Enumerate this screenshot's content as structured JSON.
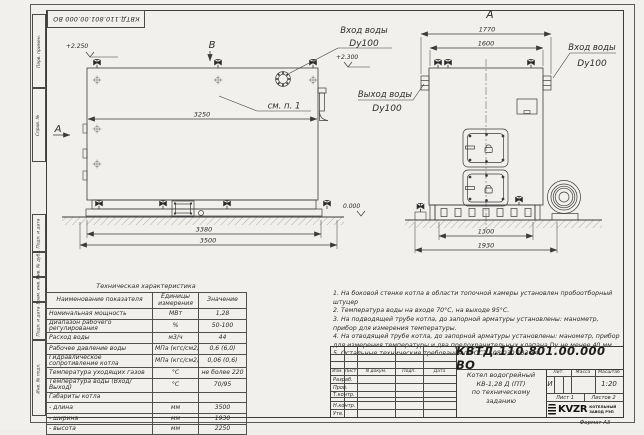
{
  "colors": {
    "paper": "#f1f0ec",
    "line": "#3b3b3b",
    "text": "#2c2c2c"
  },
  "stamp_top": "КВТД.110.801.00.000 ВО",
  "frame": {
    "format_note": "Формат А3",
    "columns": [
      "Перв. примен.",
      "Справ. №",
      "Подп. и дата",
      "Инв. № дубл.",
      "Взам. инв. №",
      "Подп. и дата",
      "Инв. № подл."
    ]
  },
  "side": {
    "view_b": "В",
    "section_a": "А",
    "elev_top": "+2.250",
    "elev_zero": "0.000",
    "see_item": "см. п. 1",
    "dim_body": "3250",
    "dim_skid": "3380",
    "dim_total": "3500"
  },
  "front": {
    "view_label": "А",
    "dim_outer": "1770",
    "dim_inner": "1600",
    "dim_skid": "1300",
    "dim_total": "1930",
    "elev_pipe": "+2.300"
  },
  "labels": {
    "inlet_top": "Вход воды",
    "inlet_top_dn": "Dy100",
    "outlet": "Выход воды",
    "outlet_dn": "Dy100",
    "inlet_right": "Вход воды",
    "inlet_right_dn": "Dy100"
  },
  "spec": {
    "title": "Техническая характеристика",
    "headers": [
      "Наименование показателя",
      "Единицы измерения",
      "Значение"
    ],
    "rows": [
      [
        "Номинальная мощность",
        "МВт",
        "1,28"
      ],
      [
        "Диапазон рабочего регулирования",
        "%",
        "50-100"
      ],
      [
        "Расход воды",
        "м3/ч",
        "44"
      ],
      [
        "Рабочее давление воды",
        "МПа (кгс/см2)",
        "0,6 (6,0)"
      ],
      [
        "Гидравлическое сопротивление котла",
        "МПа (кгс/см2)",
        "0,06 (0,6)"
      ],
      [
        "Температура уходящих газов",
        "°С",
        "не более 220"
      ],
      [
        "Температура воды (Вход/Выход)",
        "°С",
        "70/95"
      ],
      [
        "Габариты котла",
        "",
        ""
      ],
      [
        "- длина",
        "мм",
        "3500"
      ],
      [
        "- ширина",
        "мм",
        "1930"
      ],
      [
        "- высота",
        "мм",
        "2250"
      ]
    ]
  },
  "notes": [
    "1. На боковой стенке котла в области топочной камеры установлен пробоотборный штуцер",
    "2. Температура воды на входе 70°С, на выходе 95°С.",
    "3. На подводящей трубе котла, до запорной арматуры установлены: манометр, прибор для измерения температуры.",
    "4. На отводящей трубе котла, до запорной арматуры установлены: манометр, прибор для измерения температуры и два предохранительных клапана Dу не менее 40 мм.",
    "5. Остальные технические требования по ОСТ 108.030.133-84."
  ],
  "tb": {
    "doc_number": "КВТД.110.801.00.000 ВО",
    "name1": "Котел водогрейный",
    "name2": "КВ-1,28 Д (ПТ)",
    "name3": "по техническому заданию",
    "lit_h": "Лит.",
    "mass_h": "Масса",
    "scale_h": "Масштаб",
    "lit_v": "И",
    "scale_v": "1:20",
    "sheet": "Лист 1",
    "sheets": "Листов 2",
    "rev_cols": [
      "Изм.",
      "Лист",
      "N докум.",
      "Подп.",
      "Дата"
    ],
    "roles": [
      "Разраб.",
      "Пров.",
      "Т.контр.",
      "Н.контр.",
      "Утв."
    ],
    "logo": "KVZR",
    "logo_cap1": "КОТЕЛЬНЫЙ",
    "logo_cap2": "ЗАВОД РЭП"
  }
}
